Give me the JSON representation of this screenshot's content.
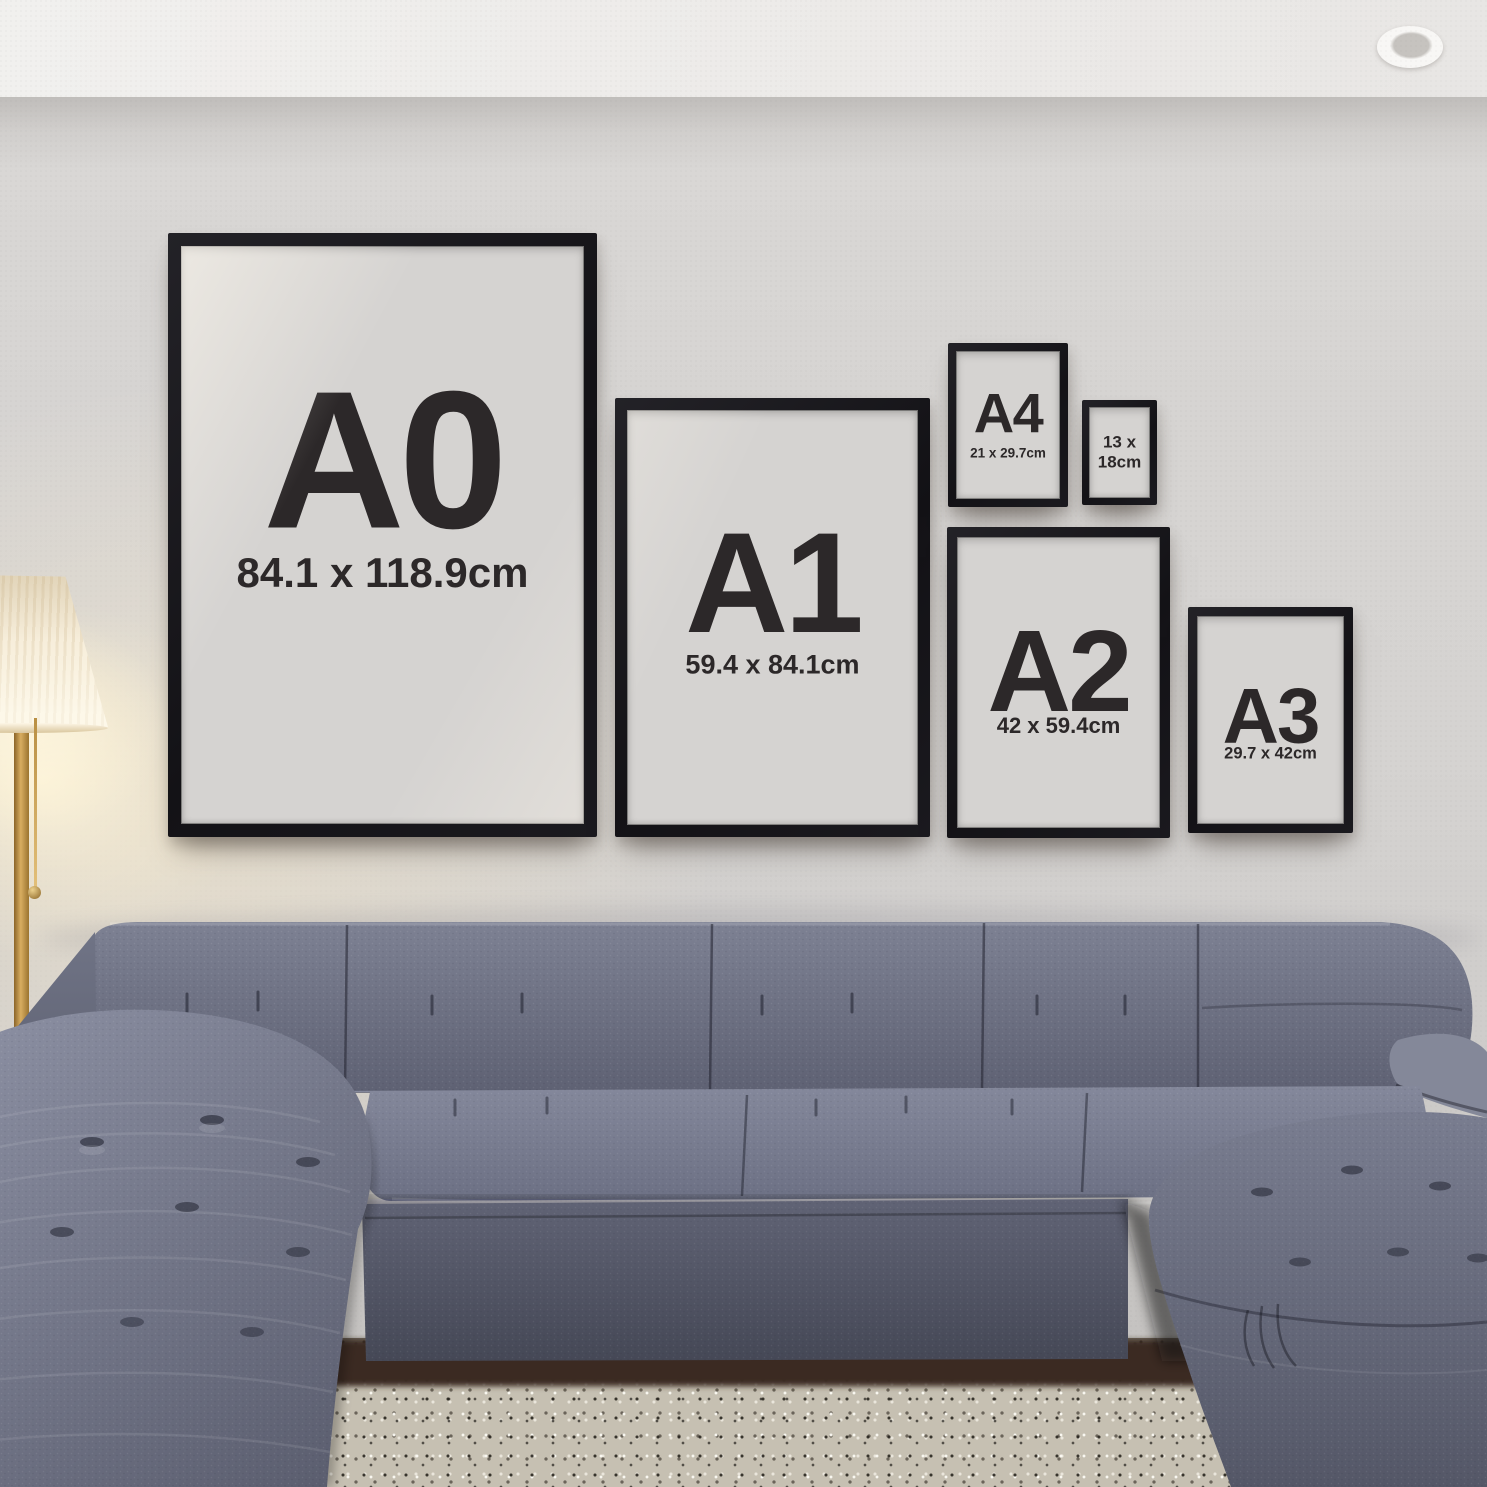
{
  "frames": [
    {
      "id": "a0",
      "label": "A0",
      "dims": "84.1 x 118.9cm"
    },
    {
      "id": "a1",
      "label": "A1",
      "dims": "59.4 x 84.1cm"
    },
    {
      "id": "a4",
      "label": "A4",
      "dims": "21 x 29.7cm"
    },
    {
      "id": "s13x18",
      "dims_line1": "13 x",
      "dims_line2": "18cm"
    },
    {
      "id": "a2",
      "label": "A2",
      "dims": "42 x 59.4cm"
    },
    {
      "id": "a3",
      "label": "A3",
      "dims": "29.7 x 42cm"
    }
  ],
  "colors": {
    "wall": "#d7d5d3",
    "ceiling": "#f0efed",
    "frame_black": "#17161a",
    "poster_gray": "#d5d3d1",
    "label_text": "#2c2829",
    "sofa_gray_blue": "#6f7386",
    "rug_beige_gray": "#c6c0b2",
    "lamp_shade_cream": "#f6eedd",
    "lamp_brass": "#b9904a",
    "floor_dark_brown": "#3a2b20"
  }
}
